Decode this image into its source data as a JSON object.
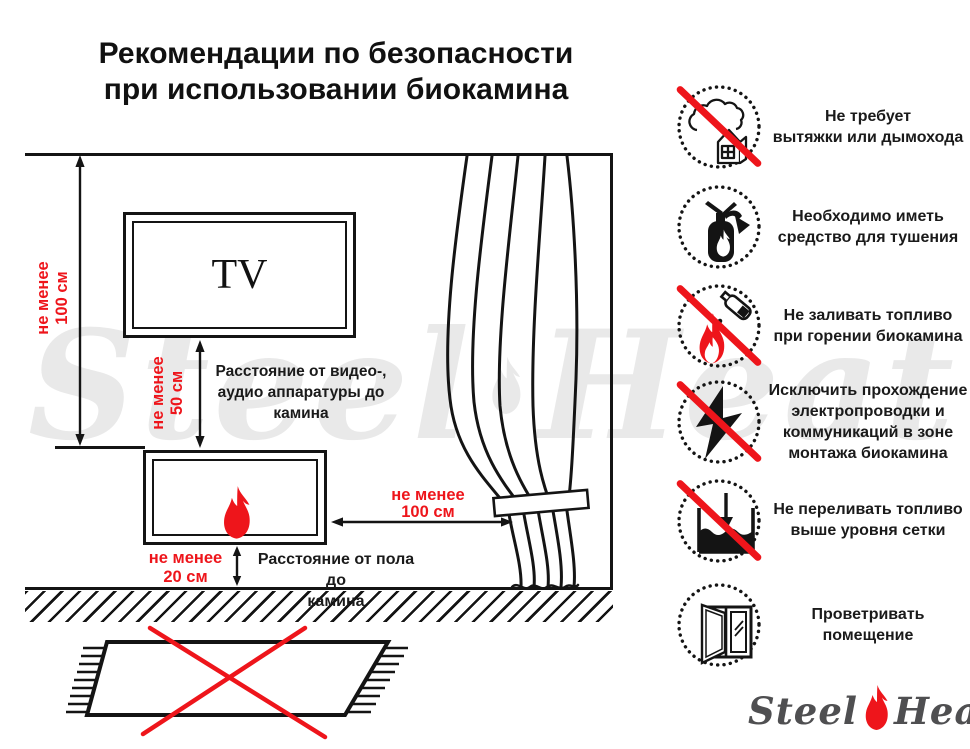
{
  "title": {
    "lines": [
      "Рекомендации по безопасности",
      "при использовании биокамина"
    ]
  },
  "diagram": {
    "tv_label": "TV",
    "wall_clearance": {
      "lines": [
        "не менее",
        "100 см"
      ]
    },
    "av_clearance": {
      "lines": [
        "не менее",
        "50 см"
      ]
    },
    "curtain_clearance": {
      "lines": [
        "не менее",
        "100 см"
      ]
    },
    "floor_clearance": {
      "lines": [
        "не менее",
        "20 см"
      ]
    },
    "av_note": {
      "lines": [
        "Расстояние от видео-,",
        "аудио аппаратуры до",
        "камина"
      ]
    },
    "floor_note": {
      "lines": [
        "Расстояние от пола до",
        "камина"
      ]
    }
  },
  "rules": [
    {
      "icon": "no-chimney-icon",
      "crossed": true,
      "lines": [
        "Не требует",
        "вытяжки или дымохода"
      ]
    },
    {
      "icon": "extinguisher-icon",
      "crossed": false,
      "lines": [
        "Необходимо иметь",
        "средство для тушения"
      ]
    },
    {
      "icon": "no-refuel-while-burning-icon",
      "crossed": true,
      "lines": [
        "Не заливать топливо",
        "при горении биокамина"
      ]
    },
    {
      "icon": "no-wiring-icon",
      "crossed": true,
      "lines": [
        "Исключить прохождение",
        "электропроводки и",
        "коммуникаций в зоне",
        "монтажа биокамина"
      ]
    },
    {
      "icon": "no-overfill-icon",
      "crossed": true,
      "lines": [
        "Не переливать топливо",
        "выше уровня сетки"
      ]
    },
    {
      "icon": "ventilate-icon",
      "crossed": false,
      "lines": [
        "Проветривать",
        "помещение"
      ]
    }
  ],
  "watermark": {
    "word1": "Steel",
    "word2": "Heat"
  },
  "logo": {
    "word1": "Steel",
    "word2": "Heat"
  },
  "colors": {
    "accent_red": "#ee151b",
    "ink": "#141414",
    "watermark_gray": "#e9e9e9",
    "logo_gray": "#4f4f51"
  }
}
